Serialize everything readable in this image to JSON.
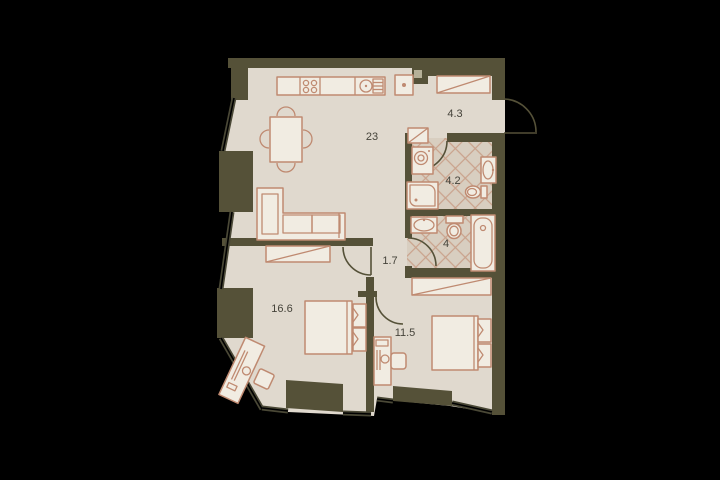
{
  "plan": {
    "type": "apartment-floor-plan",
    "background_color": "#000000",
    "floor_color": "#e0d9ce",
    "tile_color": "#d8cec0",
    "tile_line_color": "#c9a28c",
    "wall_color": "#555138",
    "furniture_line_color": "#bf8a71",
    "furniture_fill_color": "#f1ece2",
    "label_color": "#45433a",
    "rooms": [
      {
        "name": "kitchen-living-room",
        "label": "23"
      },
      {
        "name": "hallway",
        "label": "4.3"
      },
      {
        "name": "bathroom",
        "label": "4.2"
      },
      {
        "name": "wc",
        "label": "4"
      },
      {
        "name": "corridor",
        "label": "1.7"
      },
      {
        "name": "bedroom-left",
        "label": "16.6"
      },
      {
        "name": "bedroom-right",
        "label": "11.5"
      }
    ]
  }
}
